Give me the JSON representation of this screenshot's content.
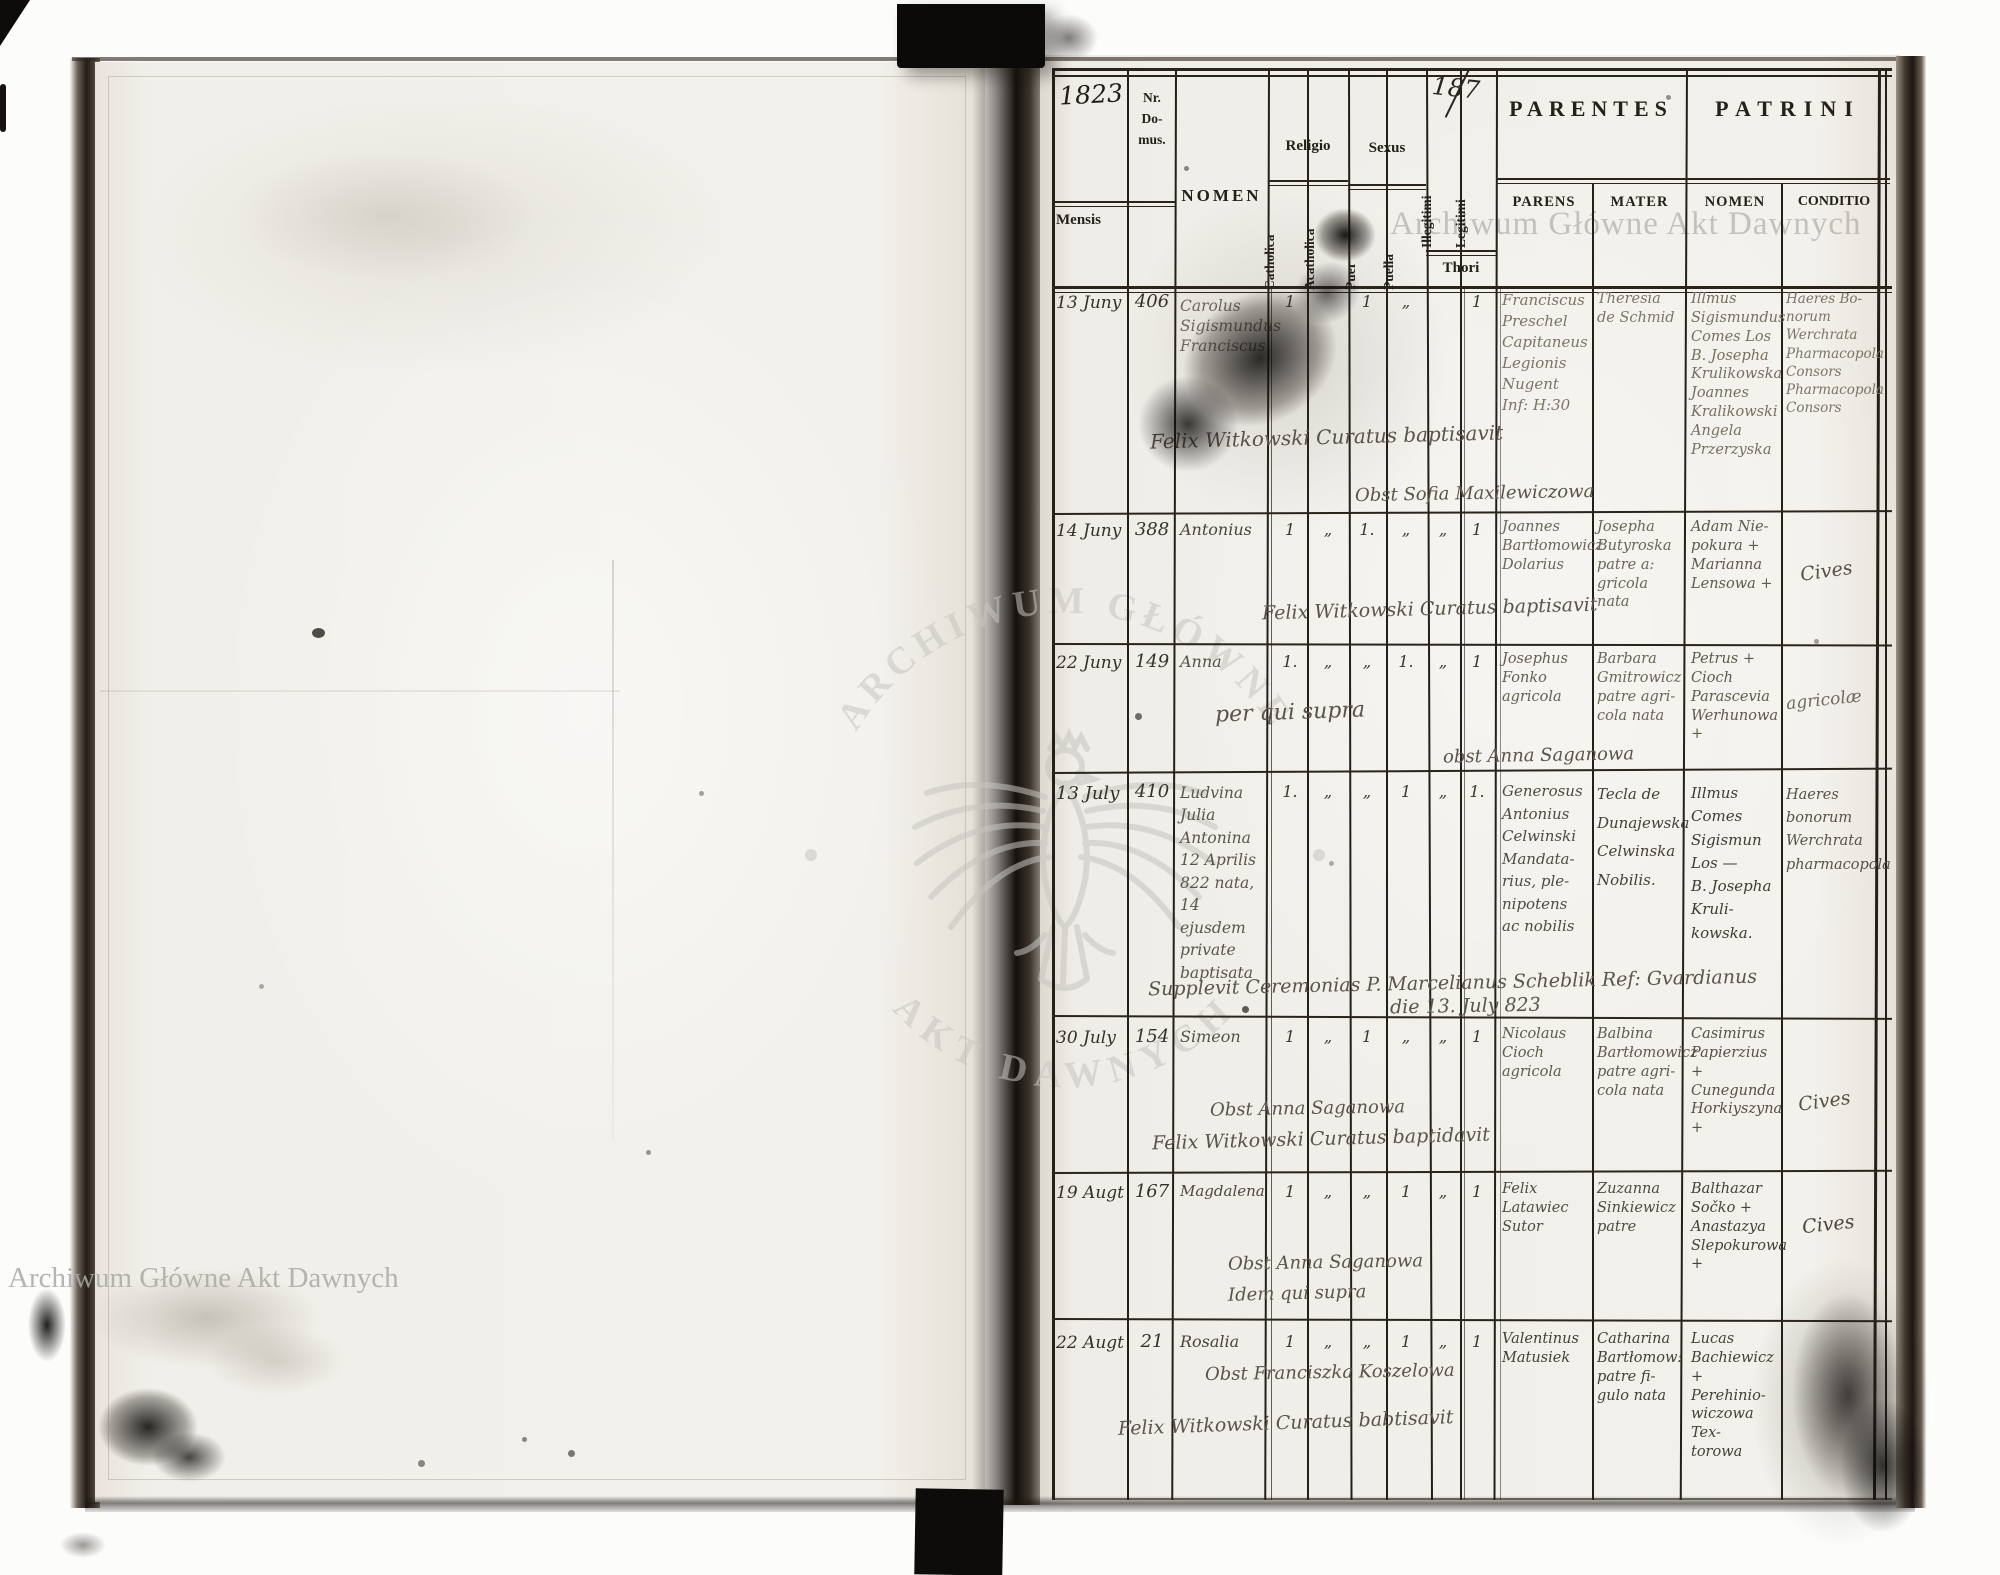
{
  "watermark": {
    "archive": "Archiwum Główne Akt Dawnych",
    "seal_top": "ARCHIWUM GŁÓWNE",
    "seal_bottom": "AKT DAWNYCH"
  },
  "annotations": {
    "year": "1823",
    "page_number": "187"
  },
  "columns": {
    "mensis": "Mensis",
    "nr_domus": "Nr.\nDo-\nmus.",
    "nomen": "NOMEN",
    "religio": "Religio",
    "sexus": "Sexus",
    "catholica": "Catholica",
    "acatholica": "Acatholica",
    "puer": "Puer",
    "puella": "Puella",
    "illegitimi": "Illegitimi",
    "legitimi": "Legitimi",
    "thori": "Thori",
    "parentes": "PARENTES",
    "patrini": "PATRINI",
    "parens": "PARENS",
    "mater": "MATER",
    "patrini_nomen": "NOMEN",
    "conditio": "CONDITIO"
  },
  "rows": [
    {
      "mensis": "13 Juny",
      "nr": "406",
      "nomen": "Carolus\nSigismundus\nFranciscus",
      "marks": {
        "cath": "1",
        "acath": "",
        "puer": "1",
        "puella": "„",
        "illeg": "",
        "legit": "1"
      },
      "parens": "Franciscus\nPreschel\nCapitaneus\nLegionis\nNugent\nInf: H:30",
      "mater": "Theresia\nde Schmid",
      "patrini_nomen": "Illmus\nSigismundus\nComes Los\nB. Josepha\nKrulikowska\nJoannes\nKralikowski\nAngela\nPrzerzyska",
      "conditio": "Haeres Bo-\nnorum\nWerchrata\nPharmacopola\nConsors\nPharmacopola\nConsors",
      "notes": [
        "Felix Witkowski Curatus baptisavit",
        "Obst Sofia Maxilewiczowa"
      ]
    },
    {
      "mensis": "14 Juny",
      "nr": "388",
      "nomen": "Antonius",
      "marks": {
        "cath": "1",
        "acath": "„",
        "puer": "1.",
        "puella": "„",
        "illeg": "„",
        "legit": "1"
      },
      "parens": "Joannes\nBartłomowicz\nDolarius",
      "mater": "Josepha\nButyroska\npatre a:\ngricola\nnata",
      "patrini_nomen": "Adam Nie-\npokura +\nMarianna\nLensowa +",
      "conditio": "Cives",
      "notes": [
        "Felix Witkowski Curatus baptisavit"
      ]
    },
    {
      "mensis": "22 Juny",
      "nr": "149",
      "nomen": "Anna",
      "marks": {
        "cath": "1.",
        "acath": "„",
        "puer": "„",
        "puella": "1.",
        "illeg": "„",
        "legit": "1"
      },
      "parens": "Josephus\nFonko\nagricola",
      "mater": "Barbara\nGmitrowicz\npatre agri-\ncola nata",
      "patrini_nomen": "Petrus +\nCioch\nParascevia\nWerhunowa +",
      "conditio": "agricolæ",
      "notes": [
        "per qui supra",
        "obst Anna Saganowa"
      ]
    },
    {
      "mensis": "13 July",
      "nr": "410",
      "nomen": "Ludvina\nJulia\nAntonina\n12 Aprilis\n822 nata,\n14 ejusdem\nprivate\nbaptisata",
      "marks": {
        "cath": "1.",
        "acath": "„",
        "puer": "„",
        "puella": "1",
        "illeg": "„",
        "legit": "1."
      },
      "parens": "Generosus\nAntonius\nCelwinski\nMandata-\nrius, ple-\nnipotens\nac nobilis",
      "mater": "Tecla de\nDunajewska\nCelwinska\nNobilis.",
      "patrini_nomen": "Illmus\nComes\nSigismun\nLos —\nB. Josepha\nKruli-\nkowska.",
      "conditio": "Haeres\nbonorum\nWerchrata\npharmacopola",
      "notes": [
        "Supplevit Ceremonias P. Marcelianus Scheblik Ref: Gvardianus",
        "die 13. July 823"
      ]
    },
    {
      "mensis": "30 July",
      "nr": "154",
      "nomen": "Simeon",
      "marks": {
        "cath": "1",
        "acath": "„",
        "puer": "1",
        "puella": "„",
        "illeg": "„",
        "legit": "1"
      },
      "parens": "Nicolaus\nCioch\nagricola",
      "mater": "Balbina\nBartłomowicz\npatre agri-\ncola nata",
      "patrini_nomen": "Casimirus\nPapierzius +\nCunegunda\nHorkiyszyna +",
      "conditio": "Cives",
      "notes": [
        "Obst Anna Saganowa",
        "Felix Witkowski Curatus baptidavit"
      ]
    },
    {
      "mensis": "19 Augt",
      "nr": "167",
      "nomen": "Magdalena",
      "marks": {
        "cath": "1",
        "acath": "„",
        "puer": "„",
        "puella": "1",
        "illeg": "„",
        "legit": "1"
      },
      "parens": "Felix\nLatawiec\nSutor",
      "mater": "Zuzanna\nSinkiewicz\npatre",
      "patrini_nomen": "Balthazar\nSočko +\nAnastazya\nSlepokurowa +",
      "conditio": "Cives",
      "notes": [
        "Obst Anna Saganowa",
        "Idem qui supra"
      ]
    },
    {
      "mensis": "22 Augt",
      "nr": "21",
      "nomen": "Rosalia",
      "marks": {
        "cath": "1",
        "acath": "„",
        "puer": "„",
        "puella": "1",
        "illeg": "„",
        "legit": "1"
      },
      "parens": "Valentinus\nMatusiek",
      "mater": "Catharina\nBartłomow:\npatre fi-\ngulo nata",
      "patrini_nomen": "Lucas\nBachiewicz +\nPerehinio-\nwiczowa Tex-\ntorowa",
      "conditio": "",
      "notes": [
        "Obst Franciszka Koszelowa",
        "Felix Witkowski Curatus babtisavit"
      ]
    }
  ]
}
